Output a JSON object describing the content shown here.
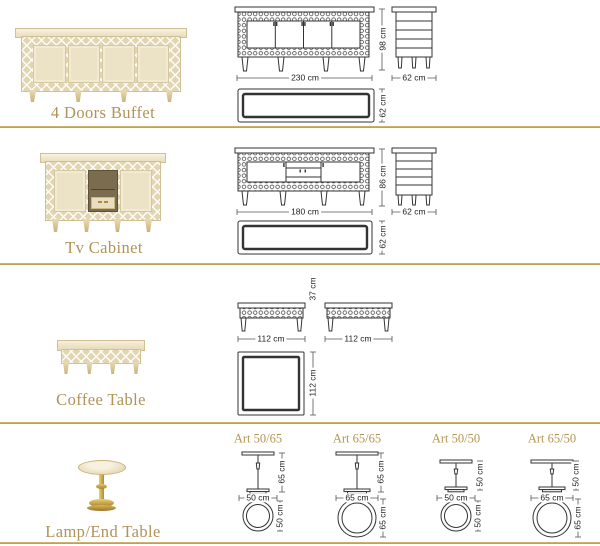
{
  "page": {
    "background": "#ffffff",
    "divider_color": "#c8a95d",
    "caption_color": "#b09358",
    "drawing_line_color": "#333333"
  },
  "sections": [
    {
      "caption": "4 Doors Buffet",
      "front": {
        "width_label": "230 cm",
        "height_label": "98 cm"
      },
      "side": {
        "width_label": "62 cm"
      },
      "top": {
        "depth_label": "62 cm"
      }
    },
    {
      "caption": "Tv Cabinet",
      "front": {
        "width_label": "180 cm",
        "height_label": "86 cm"
      },
      "side": {
        "width_label": "62 cm"
      },
      "top": {
        "depth_label": "62 cm"
      }
    },
    {
      "caption": "Coffee Table",
      "front": {
        "width_label": "112 cm",
        "height_label": "37 cm"
      },
      "side": {
        "width_label": "112 cm"
      },
      "top": {
        "depth_label": "112 cm"
      }
    },
    {
      "caption": "Lamp/End Table",
      "variants": [
        {
          "name": "Art 50/65",
          "width_label": "50 cm",
          "height_label": "65 cm",
          "diameter_label": "50 cm"
        },
        {
          "name": "Art 65/65",
          "width_label": "65 cm",
          "height_label": "65 cm",
          "diameter_label": "65 cm"
        },
        {
          "name": "Art 50/50",
          "width_label": "50 cm",
          "height_label": "50 cm",
          "diameter_label": "50 cm"
        },
        {
          "name": "Art 65/50",
          "width_label": "65 cm",
          "height_label": "50 cm",
          "diameter_label": "65 cm"
        }
      ]
    }
  ]
}
